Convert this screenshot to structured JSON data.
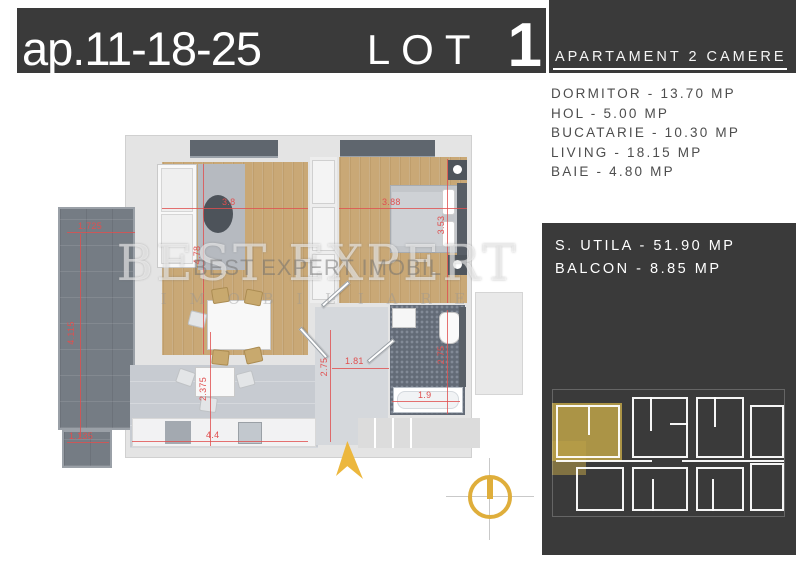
{
  "title": {
    "unit": "ap.11-18-25",
    "lot": "LOT",
    "number": "1"
  },
  "header": {
    "type": "APARTAMENT 2 CAMERE"
  },
  "rooms": [
    {
      "label": "DORMITOR - 13.70 MP"
    },
    {
      "label": "HOL - 5.00 MP"
    },
    {
      "label": "BUCATARIE - 10.30 MP"
    },
    {
      "label": "LIVING - 18.15 MP"
    },
    {
      "label": "BAIE - 4.80 MP"
    }
  ],
  "summary": {
    "utila": "S. UTILA - 51.90 MP",
    "balcon": "BALCON - 8.85 MP"
  },
  "watermark": {
    "big": "BEST EXPERT",
    "overlay": "BEST EXPERT IMOBIL",
    "sub": "I M O B I L I A R E"
  },
  "dims": {
    "balcony_w": "1.725",
    "balcony_h": "4.115",
    "balcony_b": "1.135",
    "living_w": "3.8",
    "living_h": "4.78",
    "bedroom_w": "3.88",
    "bedroom_h": "3.53",
    "kitchen_w": "4.4",
    "kitchen_h": "2.375",
    "hall_w": "1.81",
    "hall_h": "2.75",
    "bath_h": "2.75",
    "bath_w": "1.9"
  },
  "colors": {
    "panel_dark": "#3a3a3a",
    "gold": "#dfae3b",
    "dim_red": "#e04f4f",
    "wood": "#c9a876",
    "unit_highlight": "#bba048"
  }
}
